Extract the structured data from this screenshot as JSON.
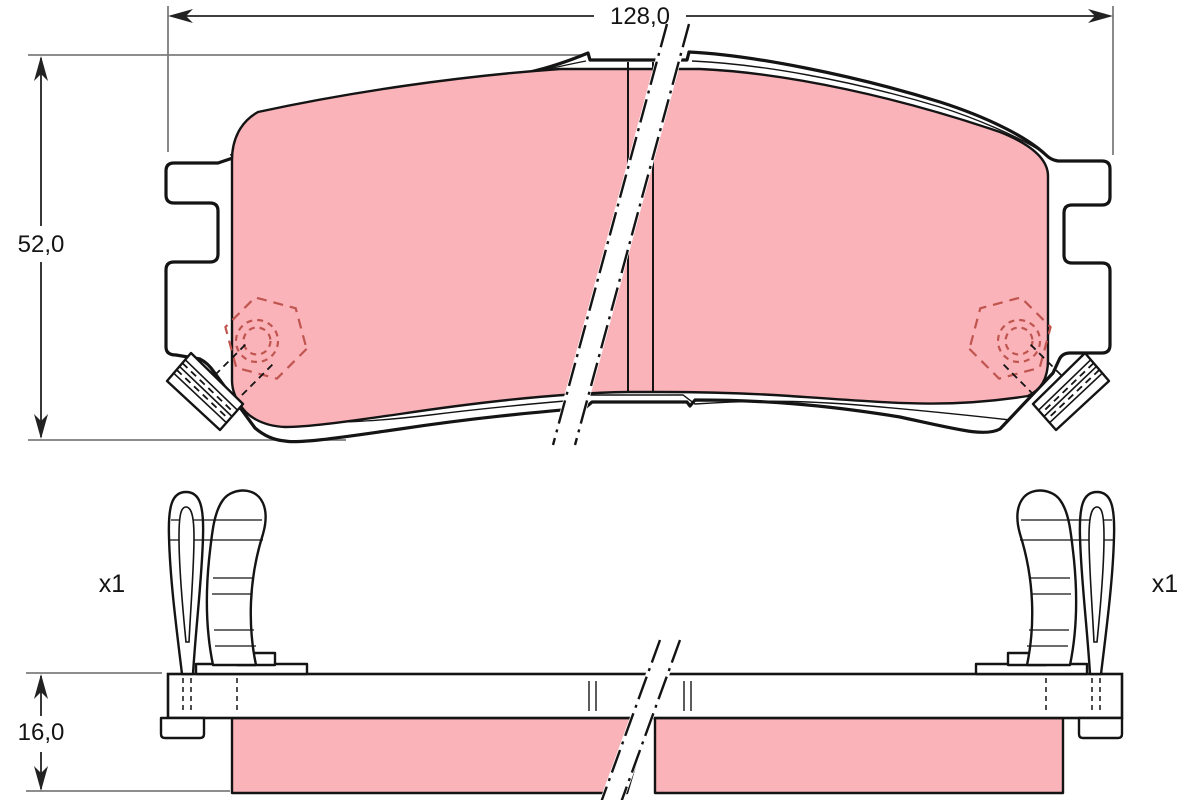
{
  "dimensions": {
    "width": "128,0",
    "height": "52,0",
    "thickness": "16,0"
  },
  "labels": {
    "left_clip_qty": "x1",
    "right_clip_qty": "x1"
  },
  "colors": {
    "friction": "#f9b3b9",
    "hidden": "#c05550",
    "line": "#141414",
    "extension": "#7d7d7d",
    "background": "#ffffff"
  }
}
